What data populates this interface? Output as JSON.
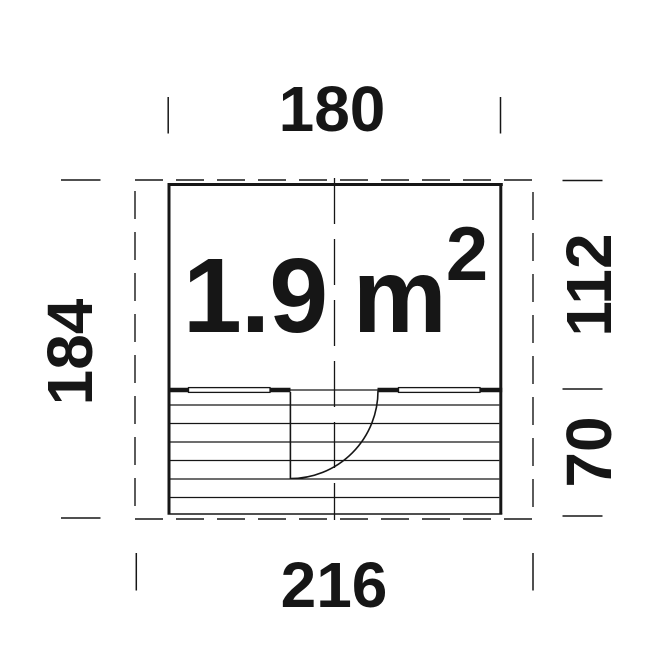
{
  "plan": {
    "area_label": {
      "value": "1.9",
      "unit": "m",
      "exponent": "2"
    },
    "dimensions": {
      "top_width": "180",
      "left_height": "184",
      "right_upper_height": "112",
      "right_lower_height": "70",
      "bottom_width": "216"
    },
    "colors": {
      "ink": "#161616",
      "background": "#ffffff"
    }
  }
}
